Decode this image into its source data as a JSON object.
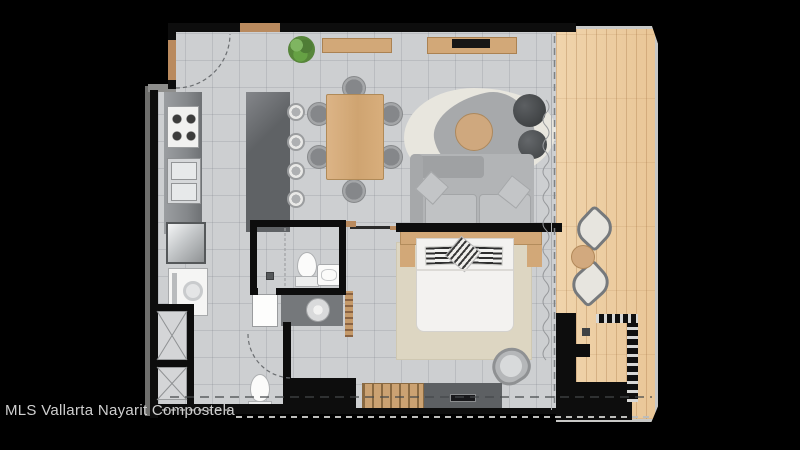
{
  "watermark": {
    "text": "MLS Vallarta Nayarit Compostela"
  },
  "palette": {
    "background": "#000000",
    "wall": "#0d0d0d",
    "floor_tile": "#cdcfd1",
    "deck_wood": "#ecca9e",
    "deck_rail": "#c8c8c6",
    "furniture_wood": "#d2a878",
    "door_wood": "#b98a5e",
    "counter_gray": "#85888b",
    "island_gray": "#5f6265",
    "upholstery_gray": "#b2b4b6",
    "rug_cream": "#e8e6de",
    "rug_blob_gray": "#a7a9ab",
    "rug_beige": "#ddd6c2",
    "bed_white": "#f3f2f0",
    "fixture_white": "#fbfbfa",
    "plant_green": "#5e9440",
    "watermark_color": "#cfcfcf"
  },
  "floorplan": {
    "type": "residential-unit-top-view-render",
    "rooms": [
      {
        "name": "kitchen",
        "items": [
          "stove-cooktop",
          "double-sink",
          "refrigerator",
          "washer",
          "counter",
          "kitchen-island",
          "bar-stool",
          "bar-stool",
          "bar-stool",
          "bar-stool"
        ]
      },
      {
        "name": "dining",
        "items": [
          "dining-table",
          "dining-chair",
          "dining-chair",
          "dining-chair",
          "dining-chair",
          "dining-chair",
          "dining-chair",
          "potted-plant",
          "sideboard"
        ]
      },
      {
        "name": "living",
        "items": [
          "tv-console",
          "tv",
          "area-rug",
          "coffee-table",
          "pouf",
          "pouf",
          "sofa"
        ]
      },
      {
        "name": "bedroom",
        "items": [
          "double-bed",
          "headboard",
          "nightstand",
          "nightstand",
          "rug",
          "accent-chair",
          "wardrobe",
          "dresser",
          "tv"
        ]
      },
      {
        "name": "bathroom",
        "items": [
          "shower",
          "toilet",
          "washbasin",
          "vanity",
          "vessel-sink",
          "door"
        ]
      },
      {
        "name": "powder-room",
        "items": [
          "toilet"
        ]
      },
      {
        "name": "hallway",
        "items": [
          "closet",
          "closet",
          "door-swing",
          "entry-door"
        ]
      },
      {
        "name": "terrace",
        "items": [
          "wood-deck",
          "lounge-chair",
          "lounge-chair",
          "side-table",
          "glass-railing",
          "louver-screen"
        ]
      }
    ]
  }
}
